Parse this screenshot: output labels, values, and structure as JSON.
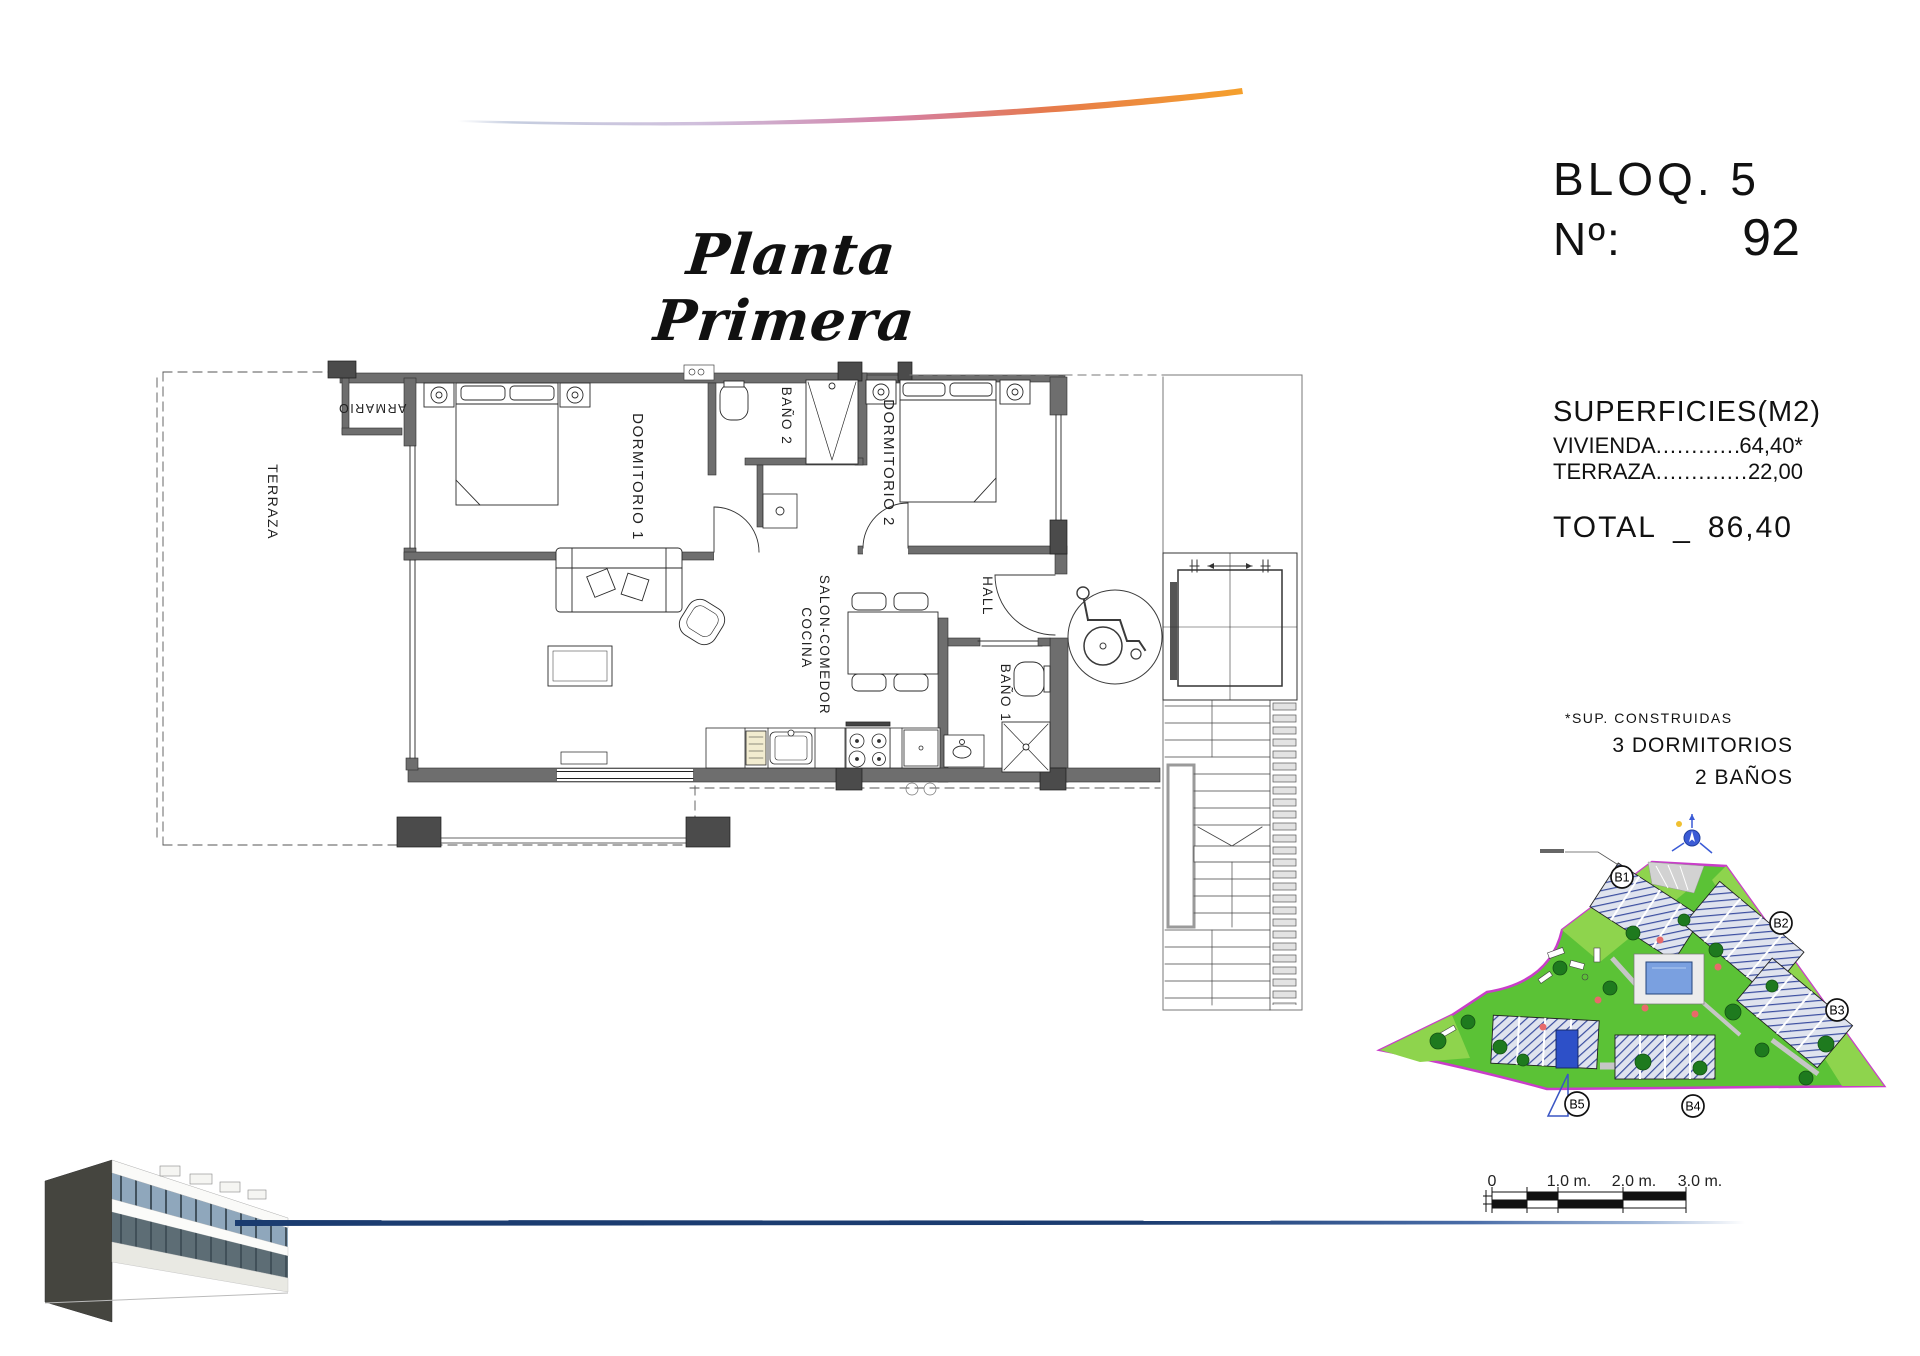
{
  "title": "Planta Primera",
  "block_info": {
    "block": "BLOQ. 5",
    "number_label": "Nº:",
    "number_value": "92"
  },
  "superficies": {
    "heading": "SUPERFICIES(M2)",
    "rows": [
      {
        "label": "VIVIENDA",
        "dots": "................",
        "value": "64,40*"
      },
      {
        "label": "TERRAZA",
        "dots": "..............",
        "value": "22,00"
      }
    ],
    "total_label": "TOTAL",
    "total_separator": "_",
    "total_value": "86,40"
  },
  "notes": {
    "footnote": "*SUP. CONSTRUIDAS",
    "bedrooms": "3 DORMITORIOS",
    "bathrooms": "2 BAÑOS"
  },
  "floor_plan": {
    "rooms": {
      "terraza": "TERRAZA",
      "armario": "ARMARIO",
      "dormitorio1": "DORMITORIO 1",
      "bano2": "BAÑO 2",
      "dormitorio2": "DORMITORIO 2",
      "hall": "HALL",
      "salon": "SALON-COMEDOR",
      "cocina": "COCINA",
      "bano1": "BAÑO 1"
    }
  },
  "site_plan": {
    "blocks": [
      "B1",
      "B2",
      "B3",
      "B4",
      "B5"
    ],
    "highlighted_block": "B5"
  },
  "scale_bar": {
    "labels": [
      "0",
      "1.0 m.",
      "2.0 m.",
      "3.0 m."
    ]
  },
  "colors": {
    "swoosh_orange": "#f09a2e",
    "bottom_line_navy": "#1b3c70",
    "site_green": "#5bc236",
    "site_green_light": "#8ed44d",
    "site_boundary_magenta": "#c93dc9",
    "building_hatch_blue": "#3b4ea0",
    "highlight_unit_blue": "#2d50c8",
    "wall_gray": "#6e6e6e"
  }
}
